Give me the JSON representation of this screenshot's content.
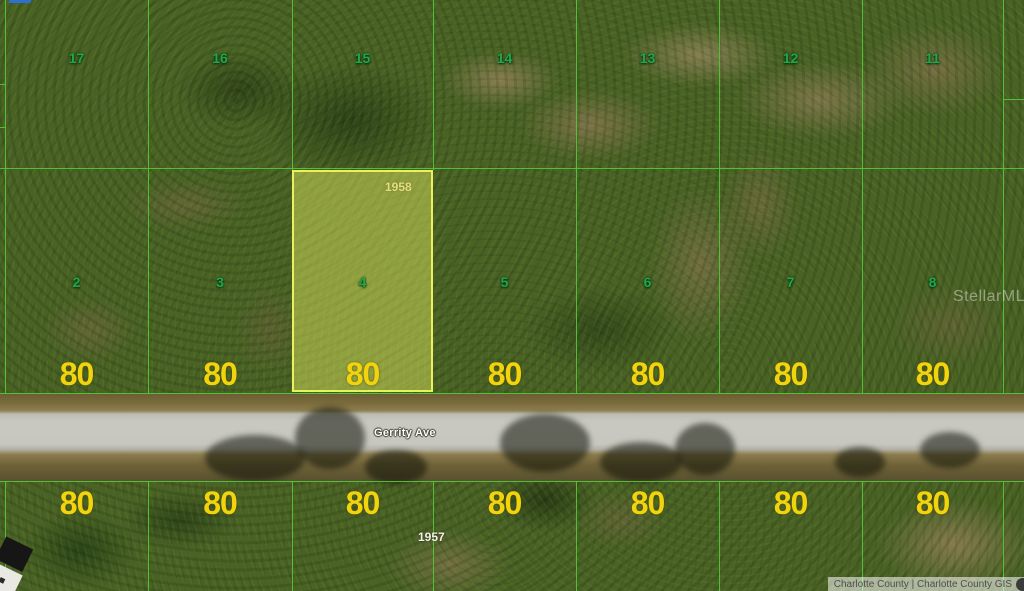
{
  "map": {
    "watermark": "StellarMLS",
    "attribution": "Charlotte County | Charlotte County GIS",
    "road": {
      "label": "Gerrity Ave"
    },
    "blocks": {
      "north_parcel_id": "1958",
      "south_parcel_id": "1957"
    },
    "highlighted_lot": "4",
    "top_row_lots": [
      "17",
      "16",
      "15",
      "14",
      "13",
      "12",
      "11"
    ],
    "middle_row_lots": [
      "2",
      "3",
      "4",
      "5",
      "6",
      "7",
      "8"
    ],
    "middle_row_widths": [
      "80",
      "80",
      "80",
      "80",
      "80",
      "80",
      "80"
    ],
    "bottom_row_widths": [
      "80",
      "80",
      "80",
      "80",
      "80",
      "80",
      "80"
    ],
    "colors": {
      "grid_line": "#50c637",
      "lot_number": "#1fa84b",
      "dimension_label": "#f2d40e",
      "highlight_fill": "rgba(230,238,95,0.45)",
      "highlight_border": "#ebf05c"
    }
  }
}
